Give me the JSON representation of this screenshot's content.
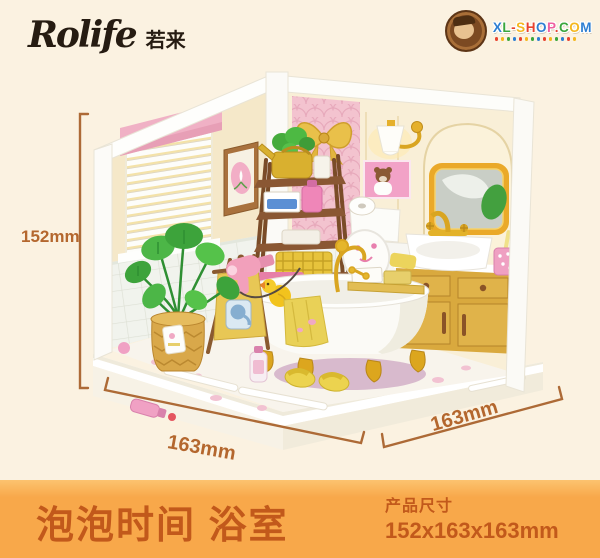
{
  "brand": {
    "logo": "Rolife",
    "logo_cn": "若来"
  },
  "retailer_badge": {
    "text": "XL-SHOP.COM",
    "letter_colors": [
      "#2e7fd2",
      "#3aa63c",
      "#e8432f",
      "#f5b71f",
      "#e8432f",
      "#2e7fd2",
      "#ef5fa0",
      "#e8432f",
      "#3aa63c",
      "#f5b71f",
      "#2e7fd2"
    ],
    "dot_count": 14,
    "dot_colors": [
      "#e8432f",
      "#f5b71f",
      "#3aa63c",
      "#2e7fd2"
    ]
  },
  "dimensions": {
    "height": "152mm",
    "depth_left": "163mm",
    "depth_right": "163mm"
  },
  "banner": {
    "product_name": "泡泡时间 浴室",
    "size_label": "产品尺寸",
    "size_value": "152x163x163mm"
  },
  "colors": {
    "background": "#fbf2e1",
    "banner_bg": "#f8a84a",
    "banner_text": "#c2591b",
    "dimension_text": "#b4672e",
    "accent_gold": "#d9a521",
    "accent_pink": "#f2c3ce",
    "vanity_yellow": "#d9a93e"
  }
}
